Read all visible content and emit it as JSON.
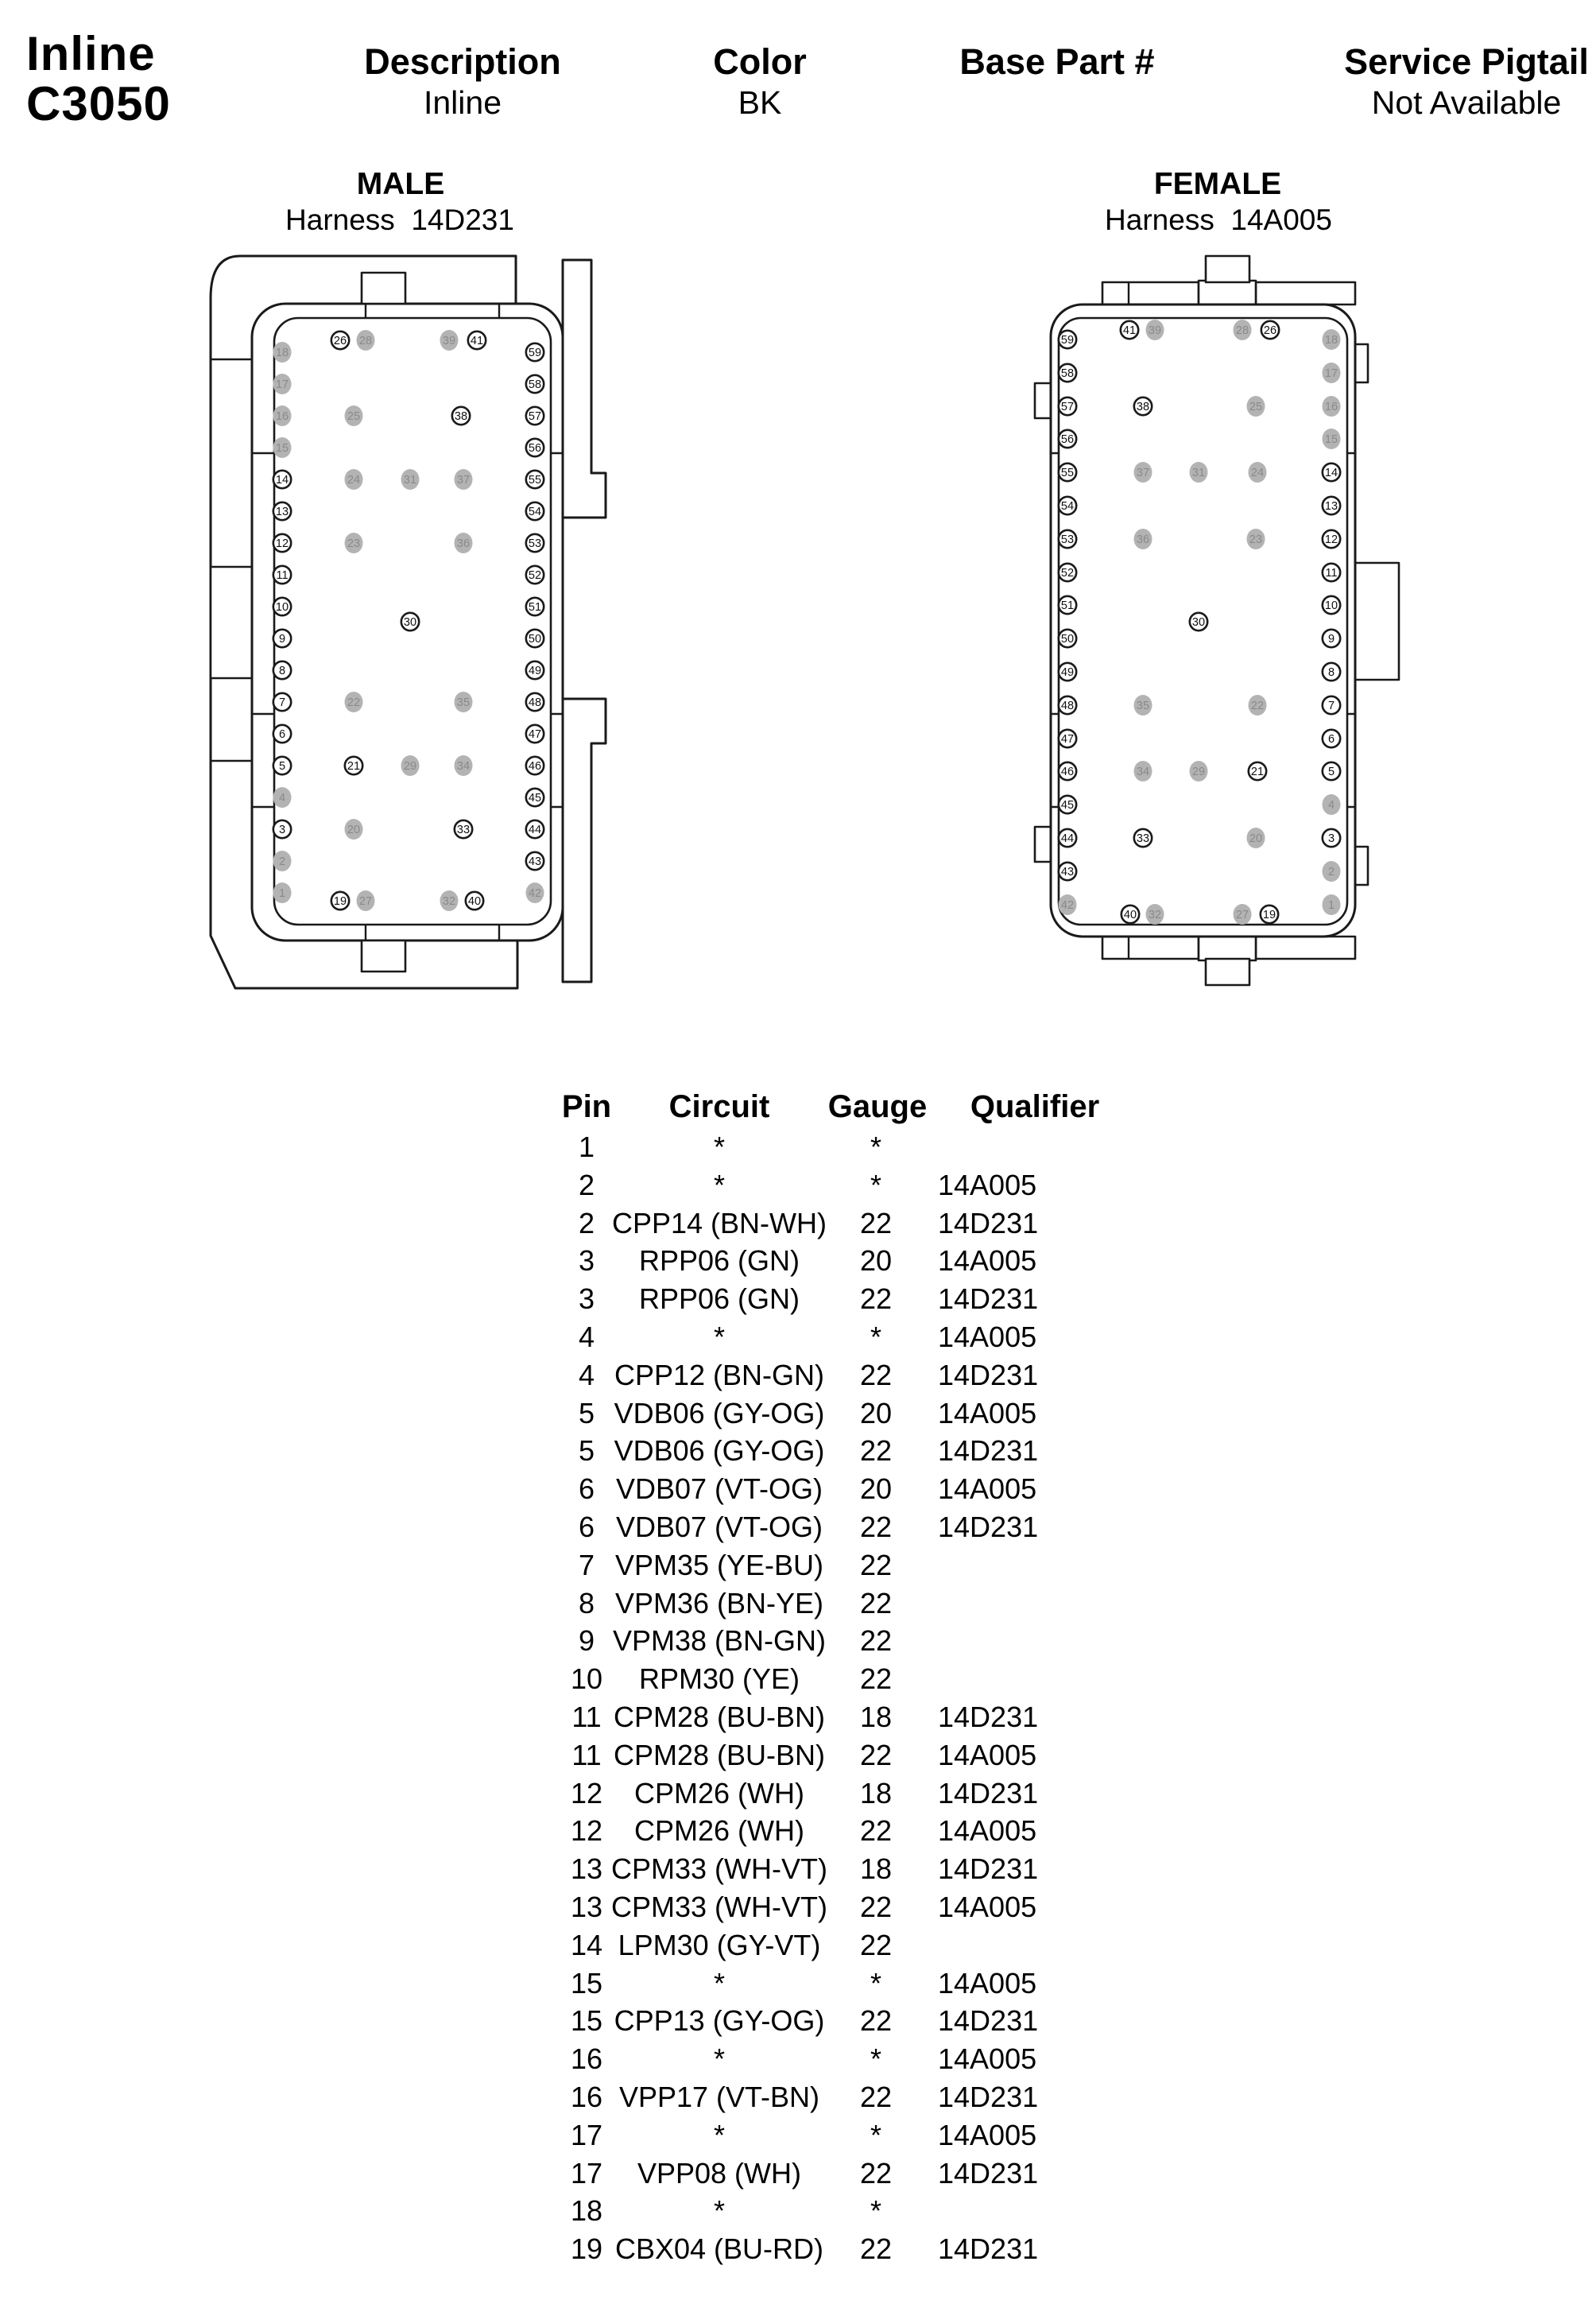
{
  "header": {
    "part_line1": "Inline",
    "part_line2": "C3050",
    "columns": [
      {
        "label": "Description",
        "value": "Inline"
      },
      {
        "label": "Color",
        "value": "BK"
      },
      {
        "label": "Base Part #",
        "value": ""
      },
      {
        "label": "Service Pigtail",
        "value": "Not Available"
      }
    ]
  },
  "connectors": [
    {
      "title": "MALE",
      "harness_line": "Harness  14D231"
    },
    {
      "title": "FEMALE",
      "harness_line": "Harness  14A005"
    }
  ],
  "pin_diagram": {
    "outline_color": "#1a1a1a",
    "pin_fill_color": "#b3b3b3",
    "pin_gray_text_color": "#8a8a8a",
    "pin_white_text_color": "#111111",
    "filled_pins": [
      1,
      2,
      4,
      15,
      16,
      17,
      18,
      20,
      22,
      23,
      24,
      25,
      27,
      28,
      29,
      31,
      32,
      34,
      35,
      36,
      37,
      39,
      42
    ],
    "male_pins": [
      [
        18,
        105,
        148
      ],
      [
        17,
        105,
        188
      ],
      [
        16,
        105,
        228
      ],
      [
        15,
        105,
        268
      ],
      [
        14,
        105,
        308
      ],
      [
        13,
        105,
        348
      ],
      [
        12,
        105,
        388
      ],
      [
        11,
        105,
        428
      ],
      [
        10,
        105,
        468
      ],
      [
        9,
        105,
        508
      ],
      [
        8,
        105,
        548
      ],
      [
        7,
        105,
        588
      ],
      [
        6,
        105,
        628
      ],
      [
        5,
        105,
        668
      ],
      [
        4,
        105,
        708
      ],
      [
        3,
        105,
        748
      ],
      [
        2,
        105,
        788
      ],
      [
        1,
        105,
        828
      ],
      [
        59,
        423,
        148
      ],
      [
        58,
        423,
        188
      ],
      [
        57,
        423,
        228
      ],
      [
        56,
        423,
        268
      ],
      [
        55,
        423,
        308
      ],
      [
        54,
        423,
        348
      ],
      [
        53,
        423,
        388
      ],
      [
        52,
        423,
        428
      ],
      [
        51,
        423,
        468
      ],
      [
        50,
        423,
        508
      ],
      [
        49,
        423,
        548
      ],
      [
        48,
        423,
        588
      ],
      [
        47,
        423,
        628
      ],
      [
        46,
        423,
        668
      ],
      [
        45,
        423,
        708
      ],
      [
        44,
        423,
        748
      ],
      [
        43,
        423,
        788
      ],
      [
        42,
        423,
        828
      ],
      [
        26,
        178,
        133
      ],
      [
        28,
        210,
        133
      ],
      [
        39,
        315,
        133
      ],
      [
        41,
        350,
        133
      ],
      [
        25,
        195,
        228
      ],
      [
        38,
        330,
        228
      ],
      [
        24,
        195,
        308
      ],
      [
        31,
        266,
        308
      ],
      [
        37,
        333,
        308
      ],
      [
        23,
        195,
        388
      ],
      [
        36,
        333,
        388
      ],
      [
        30,
        266,
        487
      ],
      [
        22,
        195,
        588
      ],
      [
        35,
        333,
        588
      ],
      [
        21,
        195,
        668
      ],
      [
        29,
        266,
        668
      ],
      [
        34,
        333,
        668
      ],
      [
        20,
        195,
        748
      ],
      [
        33,
        333,
        748
      ],
      [
        19,
        178,
        838
      ],
      [
        27,
        210,
        838
      ],
      [
        32,
        315,
        838
      ],
      [
        40,
        347,
        838
      ]
    ],
    "female_pins": [
      [
        59,
        63,
        132
      ],
      [
        58,
        63,
        174
      ],
      [
        57,
        63,
        216
      ],
      [
        56,
        63,
        257
      ],
      [
        55,
        63,
        299
      ],
      [
        54,
        63,
        341
      ],
      [
        53,
        63,
        383
      ],
      [
        52,
        63,
        425
      ],
      [
        51,
        63,
        466
      ],
      [
        50,
        63,
        508
      ],
      [
        49,
        63,
        550
      ],
      [
        48,
        63,
        592
      ],
      [
        47,
        63,
        634
      ],
      [
        46,
        63,
        675
      ],
      [
        45,
        63,
        717
      ],
      [
        44,
        63,
        759
      ],
      [
        43,
        63,
        801
      ],
      [
        42,
        63,
        843
      ],
      [
        18,
        395,
        132
      ],
      [
        17,
        395,
        174
      ],
      [
        16,
        395,
        216
      ],
      [
        15,
        395,
        257
      ],
      [
        14,
        395,
        299
      ],
      [
        13,
        395,
        341
      ],
      [
        12,
        395,
        383
      ],
      [
        11,
        395,
        425
      ],
      [
        10,
        395,
        466
      ],
      [
        9,
        395,
        508
      ],
      [
        8,
        395,
        550
      ],
      [
        7,
        395,
        592
      ],
      [
        6,
        395,
        634
      ],
      [
        5,
        395,
        675
      ],
      [
        4,
        395,
        717
      ],
      [
        3,
        395,
        759
      ],
      [
        2,
        395,
        801
      ],
      [
        1,
        395,
        843
      ],
      [
        41,
        141,
        120
      ],
      [
        39,
        173,
        120
      ],
      [
        28,
        283,
        120
      ],
      [
        26,
        318,
        120
      ],
      [
        38,
        158,
        216
      ],
      [
        25,
        300,
        216
      ],
      [
        37,
        158,
        299
      ],
      [
        31,
        228,
        299
      ],
      [
        24,
        302,
        299
      ],
      [
        36,
        158,
        383
      ],
      [
        23,
        300,
        383
      ],
      [
        30,
        228,
        487
      ],
      [
        35,
        158,
        592
      ],
      [
        22,
        302,
        592
      ],
      [
        34,
        158,
        675
      ],
      [
        29,
        228,
        675
      ],
      [
        21,
        302,
        675
      ],
      [
        33,
        158,
        759
      ],
      [
        20,
        300,
        759
      ],
      [
        40,
        142,
        855
      ],
      [
        32,
        173,
        855
      ],
      [
        27,
        283,
        855
      ],
      [
        19,
        317,
        855
      ]
    ]
  },
  "table": {
    "headers": [
      "Pin",
      "Circuit",
      "Gauge",
      "Qualifier"
    ],
    "rows": [
      [
        "1",
        "*",
        "*",
        ""
      ],
      [
        "2",
        "*",
        "*",
        "14A005"
      ],
      [
        "2",
        "CPP14 (BN-WH)",
        "22",
        "14D231"
      ],
      [
        "3",
        "RPP06 (GN)",
        "20",
        "14A005"
      ],
      [
        "3",
        "RPP06 (GN)",
        "22",
        "14D231"
      ],
      [
        "4",
        "*",
        "*",
        "14A005"
      ],
      [
        "4",
        "CPP12 (BN-GN)",
        "22",
        "14D231"
      ],
      [
        "5",
        "VDB06 (GY-OG)",
        "20",
        "14A005"
      ],
      [
        "5",
        "VDB06 (GY-OG)",
        "22",
        "14D231"
      ],
      [
        "6",
        "VDB07 (VT-OG)",
        "20",
        "14A005"
      ],
      [
        "6",
        "VDB07 (VT-OG)",
        "22",
        "14D231"
      ],
      [
        "7",
        "VPM35 (YE-BU)",
        "22",
        ""
      ],
      [
        "8",
        "VPM36 (BN-YE)",
        "22",
        ""
      ],
      [
        "9",
        "VPM38 (BN-GN)",
        "22",
        ""
      ],
      [
        "10",
        "RPM30 (YE)",
        "22",
        ""
      ],
      [
        "11",
        "CPM28 (BU-BN)",
        "18",
        "14D231"
      ],
      [
        "11",
        "CPM28 (BU-BN)",
        "22",
        "14A005"
      ],
      [
        "12",
        "CPM26 (WH)",
        "18",
        "14D231"
      ],
      [
        "12",
        "CPM26 (WH)",
        "22",
        "14A005"
      ],
      [
        "13",
        "CPM33 (WH-VT)",
        "18",
        "14D231"
      ],
      [
        "13",
        "CPM33 (WH-VT)",
        "22",
        "14A005"
      ],
      [
        "14",
        "LPM30 (GY-VT)",
        "22",
        ""
      ],
      [
        "15",
        "*",
        "*",
        "14A005"
      ],
      [
        "15",
        "CPP13 (GY-OG)",
        "22",
        "14D231"
      ],
      [
        "16",
        "*",
        "*",
        "14A005"
      ],
      [
        "16",
        "VPP17 (VT-BN)",
        "22",
        "14D231"
      ],
      [
        "17",
        "*",
        "*",
        "14A005"
      ],
      [
        "17",
        "VPP08 (WH)",
        "22",
        "14D231"
      ],
      [
        "18",
        "*",
        "*",
        ""
      ],
      [
        "19",
        "CBX04 (BU-RD)",
        "22",
        "14D231"
      ]
    ]
  }
}
